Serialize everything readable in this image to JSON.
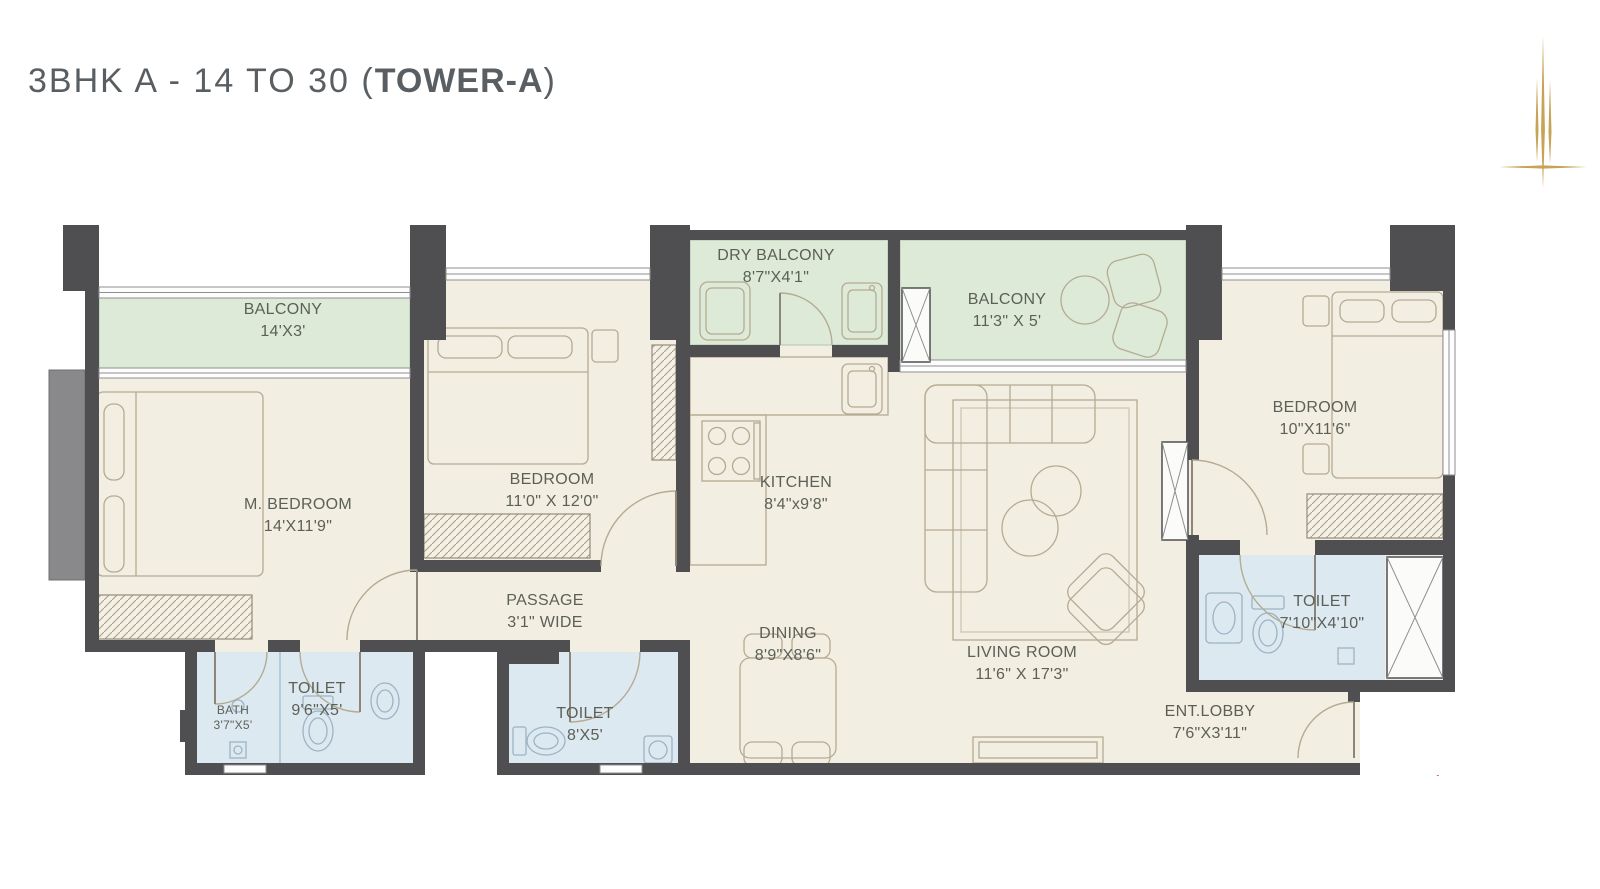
{
  "header": {
    "title_main": "3BHK A - 14 TO 30 (",
    "title_bold": "TOWER-A",
    "title_close": ")"
  },
  "rooms": {
    "balcony_left": {
      "name": "BALCONY",
      "dims": "14'X3'"
    },
    "m_bedroom": {
      "name": "M. BEDROOM",
      "dims": "14'X11'9\""
    },
    "bedroom_2": {
      "name": "BEDROOM",
      "dims": "11'0\" X 12'0\""
    },
    "dry_balcony": {
      "name": "DRY BALCONY",
      "dims": "8'7\"X4'1\""
    },
    "kitchen": {
      "name": "KITCHEN",
      "dims": "8'4\"x9'8\""
    },
    "balcony_right": {
      "name": "BALCONY",
      "dims": "11'3\" X 5'"
    },
    "bedroom_3": {
      "name": "BEDROOM",
      "dims": "10\"X11'6\""
    },
    "toilet_right": {
      "name": "TOILET",
      "dims": "7'10\"X4'10\""
    },
    "passage": {
      "name": "PASSAGE",
      "dims": "3'1\" WIDE"
    },
    "dining": {
      "name": "DINING",
      "dims": "8'9\"X8'6\""
    },
    "living_room": {
      "name": "LIVING ROOM",
      "dims": "11'6\" X 17'3\""
    },
    "ent_lobby": {
      "name": "ENT.LOBBY",
      "dims": "7'6\"X3'11\""
    },
    "bath": {
      "name": "BATH",
      "dims": "3'7\"X5'"
    },
    "toilet_left": {
      "name": "TOILET",
      "dims": "9'6\"X5'"
    },
    "toilet_mid": {
      "name": "TOILET",
      "dims": "8'X5'"
    }
  },
  "colors": {
    "wall": "#4f4f51",
    "floor": "#f2eee2",
    "balcony_green": "#dcead7",
    "toilet_blue": "#dde9f1",
    "furniture_line": "#b5ab93",
    "label_text": "#5c6057",
    "title_text": "#595e62",
    "logo_gold": "#c7a257",
    "entry_arrow_red": "#c23b3b"
  },
  "icons": {
    "logo": "tower-logo",
    "entry_arrow": "entry-direction-chevron"
  }
}
